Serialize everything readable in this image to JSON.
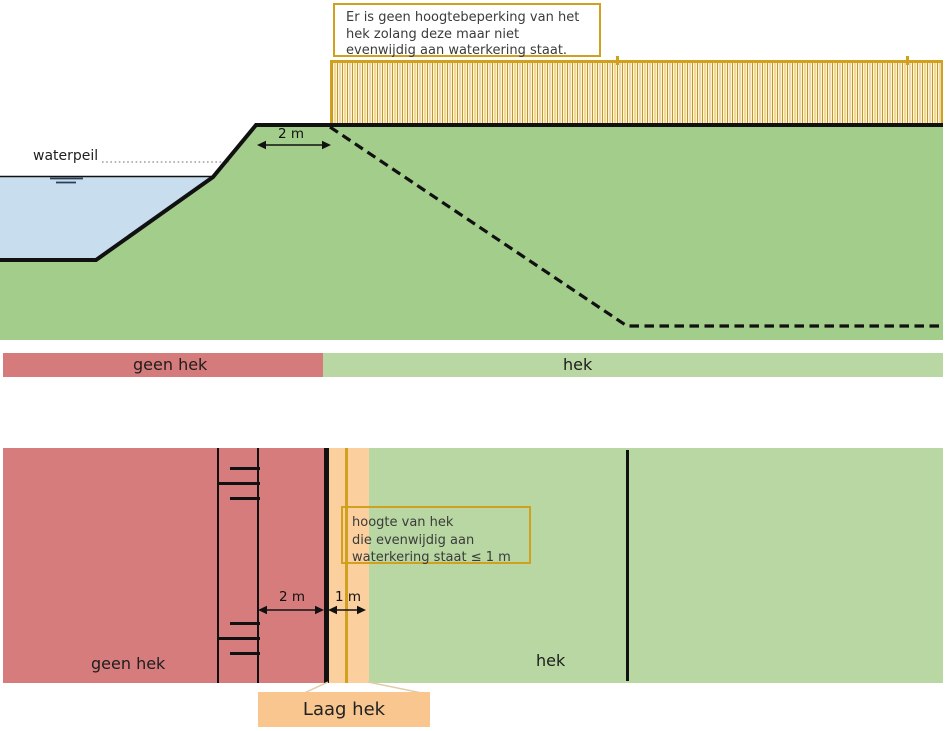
{
  "colors": {
    "gold": "#d0a01f",
    "dike_green": "#a3cd8b",
    "zone_green": "#b8d7a2",
    "zone_red": "#d67b7b",
    "water_blue": "#c8ddee",
    "orange_strip": "#fbcf9e",
    "callout_orange": "#f9c68f",
    "line_black": "#111111"
  },
  "top_diagram": {
    "note_box": {
      "lines": [
        "Er is geen hoogtebeperking van het",
        "hek zolang deze maar niet",
        "evenwijdig aan waterkering staat."
      ]
    },
    "waterpeil_label": "waterpeil",
    "crest_width_label": "2 m",
    "zone_bar": {
      "no_fence_label": "geen hek",
      "fence_label": "hek"
    }
  },
  "bottom_diagram": {
    "note_box": {
      "lines": [
        "hoogte van hek",
        "die evenwijdig aan",
        "waterkering staat ≤ 1 m"
      ]
    },
    "crest_width_label": "2 m",
    "strip_width_label": "1 m",
    "no_fence_label": "geen hek",
    "fence_label": "hek",
    "callout_label": "Laag hek"
  }
}
